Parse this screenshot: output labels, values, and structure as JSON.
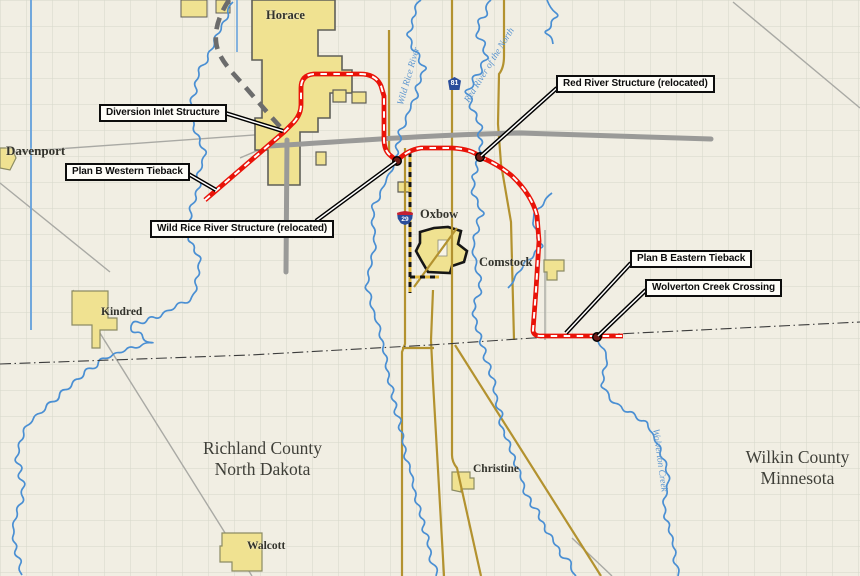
{
  "map": {
    "callouts": [
      {
        "id": "diversion-inlet-structure",
        "label": "Diversion Inlet Structure"
      },
      {
        "id": "plan-b-western-tieback",
        "label": "Plan B Western Tieback"
      },
      {
        "id": "wild-rice-river-structure",
        "label": "Wild Rice River Structure (relocated)"
      },
      {
        "id": "red-river-structure",
        "label": "Red River Structure (relocated)"
      },
      {
        "id": "plan-b-eastern-tieback",
        "label": "Plan B Eastern Tieback"
      },
      {
        "id": "wolverton-creek-crossing",
        "label": "Wolverton Creek Crossing"
      }
    ],
    "towns": [
      {
        "name": "Horace"
      },
      {
        "name": "Davenport"
      },
      {
        "name": "Kindred"
      },
      {
        "name": "Walcott"
      },
      {
        "name": "Oxbow"
      },
      {
        "name": "Comstock"
      },
      {
        "name": "Christine"
      }
    ],
    "counties": [
      {
        "line1": "Richland County",
        "line2": "North Dakota"
      },
      {
        "line1": "Wilkin County",
        "line2": "Minnesota"
      }
    ],
    "water_labels": [
      {
        "name": "Wild Rice River"
      },
      {
        "name": "Red River of the North"
      },
      {
        "name": "Wolverton Creek"
      }
    ],
    "shields": [
      {
        "type": "county-route",
        "number": "81"
      },
      {
        "type": "interstate",
        "number": "29"
      }
    ]
  },
  "colors": {
    "background": "#f1eee3",
    "grid": "#d5d7ca",
    "water": "#4a8fd3",
    "drain": "#6aa3dc",
    "road_minor": "#a9a9a4",
    "road_major": "#9a9a98",
    "road_highway": "#b3922f",
    "construction_yellow": "#e0b73c",
    "construction_black": "#141414",
    "town_fill": "#f0e291",
    "town_border": "#8c8c64",
    "horace_border": "#5f5f58",
    "oxbow_border": "#161616",
    "route_red": "#e91309",
    "route_dash": "#ffffff",
    "alignment_gray": "#6c6c6c",
    "county_line": "#3c3c3c",
    "structure_dot": "#6f1b16",
    "dot_ring": "#000000",
    "shield_blue": "#2a4d9b",
    "shield_red": "#c32032"
  }
}
